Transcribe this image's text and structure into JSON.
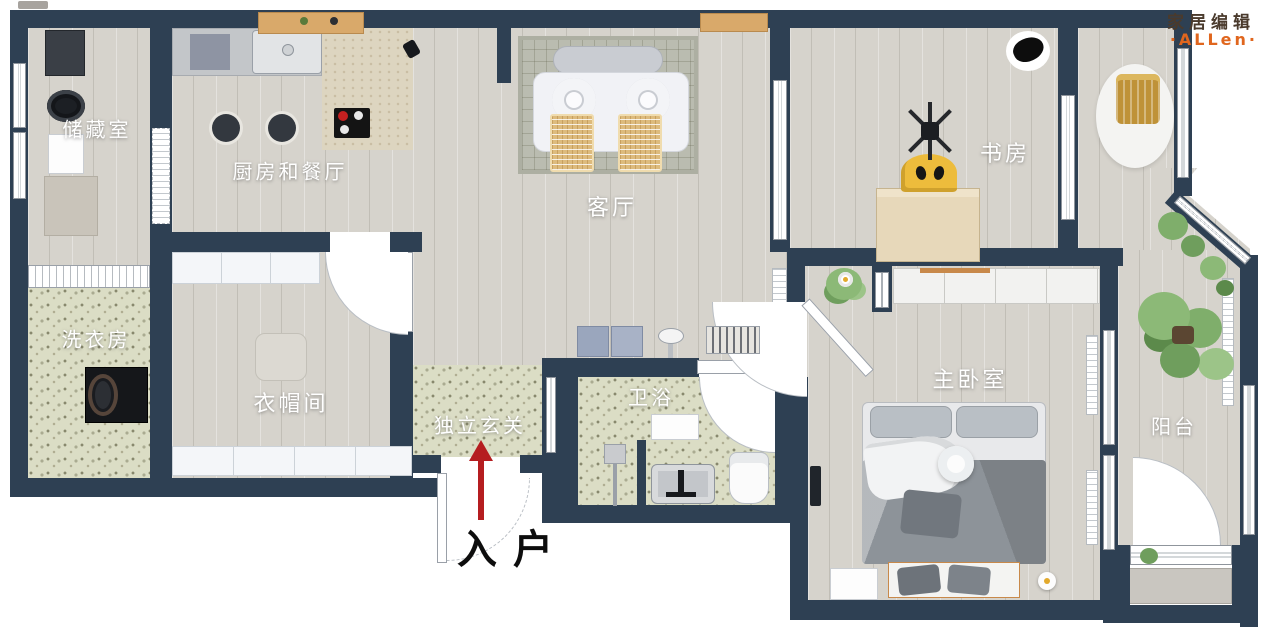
{
  "watermark": {
    "line1": "家居编辑",
    "line2": "·ALLen·"
  },
  "entrance": {
    "label": "入户"
  },
  "rooms": {
    "storage": {
      "label": "储藏室"
    },
    "kitchen_dining": {
      "label": "厨房和餐厅"
    },
    "living": {
      "label": "客厅"
    },
    "study": {
      "label": "书房"
    },
    "laundry": {
      "label": "洗衣房"
    },
    "closet": {
      "label": "衣帽间"
    },
    "entry_hall": {
      "label": "独立玄关"
    },
    "bathroom": {
      "label": "卫浴"
    },
    "master_bedroom": {
      "label": "主卧室"
    },
    "balcony": {
      "label": "阳台"
    }
  },
  "colors": {
    "wall": "#2e4053",
    "floor_wood": "#d6d3cc",
    "floor_terrazzo": "#dbddc5",
    "floor_tile_beige": "#ddd5c0",
    "living_rug": "#babcb0",
    "rattan_chair": "#ddbb7d",
    "gold_stool": "#bf9238",
    "study_desk": "#e7d8ba",
    "study_chair_yellow": "#edbc3c",
    "bed_gray": "#8d9399",
    "plant_green": "#7fae6b",
    "arrow_red": "#b51d20",
    "watermark_brown": "#4a3a2c",
    "watermark_orange": "#e0661e"
  }
}
